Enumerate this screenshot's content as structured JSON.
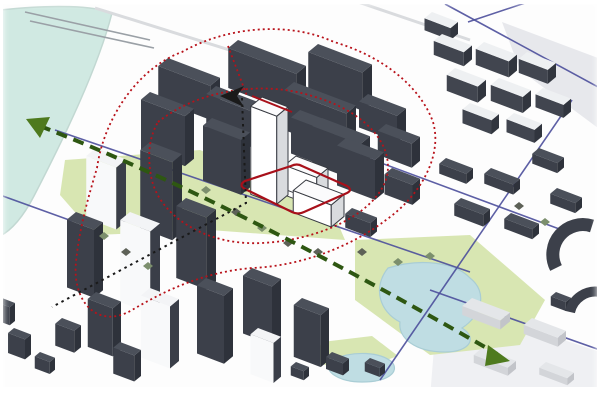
{
  "meta": {
    "title": "Urban design analysis diagram: axonometric city massing with landmark towers, view-axis arrows, influence loops, park and river",
    "canvas": {
      "w": 600,
      "h": 400
    }
  },
  "palette": {
    "ground": "#fdfdfd",
    "water": "#d0e9e2",
    "waterEdge": "#c2d8d2",
    "park": "#d6e5ae",
    "park2": "#dbe8ba",
    "pond": "#bfdde3",
    "pondEdge": "#a9cdd5",
    "road": "#4c4f9c",
    "faintStreet": "#d9dbde",
    "plate": "#e7e8ec",
    "plate2": "#eff0f3",
    "bridge": "#9aa0a6",
    "redLine": "#b8121a",
    "redSolid": "#a8101a",
    "black": "#1a1a1a",
    "greenAxis": "#2e5712",
    "greenArrow": "#4e7a1e",
    "tree1": "#7c8f6d",
    "tree2": "#5d6157",
    "styles": {
      "dark": {
        "top": "#4b505a",
        "left": "#3c404a",
        "right": "#2e323b"
      },
      "darkLightTop": {
        "top": "#eef0f2",
        "left": "#41454f",
        "right": "#31353e"
      },
      "lightSide": {
        "top": "#f3f4f6",
        "left": "#f8f9fa",
        "right": "#3a3e48"
      },
      "white": {
        "top": "#fbfbfc",
        "left": "#ffffff",
        "right": "#d9dbde",
        "stroke": "#383b42"
      },
      "lowGray": {
        "top": "#e4e6e9",
        "left": "#d3d5d9",
        "right": "#c2c4c9"
      }
    }
  },
  "scene": {
    "water": {
      "path": "M 0,10 C 55,4 95,6 112,13 C 98,68 64,138 34,196 C 22,219 10,231 0,236 Z"
    },
    "bridge": {
      "lines": [
        [
          25,
          12,
          150,
          40
        ],
        [
          30,
          21,
          154,
          48
        ]
      ]
    },
    "faintStreets": [
      [
        95,
        8,
        268,
        62
      ],
      [
        358,
        2,
        470,
        40
      ]
    ],
    "groundPlates": [
      {
        "points": "502,22 598,58 598,128 520,70",
        "fill": "plate"
      },
      {
        "points": "438,298 600,352 600,398 430,398",
        "fill": "plate2"
      }
    ],
    "parks": [
      {
        "path": "M 65,160 L 200,150 L 330,205 L 345,240 L 210,230 L 95,235 L 60,195 Z"
      },
      {
        "path": "M 355,240 L 470,235 L 545,300 L 520,345 L 430,355 L 355,300 Z"
      },
      {
        "path": "M 322,342 L 372,336 L 398,356 L 352,372 L 314,362 Z"
      }
    ],
    "pond": {
      "paths": [
        "M 388,268 C 420,258 455,262 470,278 C 488,292 482,315 462,328 C 478,338 470,352 445,352 C 415,352 398,338 400,322 C 380,312 372,288 388,268 Z",
        "M 330,360 C 355,350 380,352 392,362 C 400,372 388,382 362,382 C 340,382 322,372 330,360 Z"
      ]
    },
    "roads": [
      [
        445,
        4,
        600,
        88
      ],
      [
        468,
        22,
        528,
        2
      ],
      [
        572,
        100,
        380,
        380
      ],
      [
        168,
        84,
        562,
        230
      ],
      [
        55,
        130,
        470,
        272
      ],
      [
        430,
        290,
        600,
        350
      ],
      [
        0,
        195,
        72,
        221
      ]
    ],
    "buildings": [
      [
        168,
        58,
        52,
        13,
        34,
        "dark"
      ],
      [
        238,
        40,
        68,
        13,
        40,
        "dark"
      ],
      [
        318,
        44,
        54,
        13,
        38,
        "dark"
      ],
      [
        150,
        92,
        44,
        12,
        50,
        "dark"
      ],
      [
        216,
        86,
        58,
        13,
        36,
        "dark"
      ],
      [
        294,
        82,
        62,
        13,
        40,
        "dark"
      ],
      [
        368,
        94,
        38,
        12,
        26,
        "dark"
      ],
      [
        212,
        118,
        38,
        12,
        55,
        "dark"
      ],
      [
        322,
        118,
        48,
        13,
        38,
        "dark"
      ],
      [
        386,
        124,
        34,
        11,
        24,
        "dark"
      ],
      [
        300,
        110,
        34,
        12,
        36,
        "dark"
      ],
      [
        442,
        34,
        30,
        11,
        14,
        "darkLightTop"
      ],
      [
        484,
        42,
        33,
        11,
        16,
        "darkLightTop"
      ],
      [
        527,
        52,
        29,
        11,
        14,
        "darkLightTop"
      ],
      [
        455,
        68,
        31,
        11,
        16,
        "darkLightTop"
      ],
      [
        499,
        78,
        32,
        11,
        16,
        "darkLightTop"
      ],
      [
        543,
        88,
        28,
        10,
        13,
        "darkLightTop"
      ],
      [
        470,
        103,
        29,
        10,
        14,
        "darkLightTop"
      ],
      [
        514,
        113,
        28,
        10,
        13,
        "darkLightTop"
      ],
      [
        432,
        12,
        26,
        10,
        12,
        "darkLightTop"
      ],
      [
        446,
        158,
        27,
        9,
        10,
        "dark"
      ],
      [
        491,
        168,
        29,
        9,
        10,
        "dark"
      ],
      [
        539,
        148,
        25,
        9,
        10,
        "dark"
      ],
      [
        461,
        198,
        29,
        9,
        12,
        "dark"
      ],
      [
        511,
        213,
        28,
        9,
        10,
        "dark"
      ],
      [
        557,
        188,
        25,
        9,
        10,
        "dark"
      ],
      [
        96,
        148,
        30,
        13,
        62,
        "lightSide"
      ],
      [
        150,
        142,
        32,
        13,
        78,
        "dark"
      ],
      [
        76,
        212,
        27,
        12,
        68,
        "dark"
      ],
      [
        130,
        212,
        30,
        13,
        82,
        "lightSide"
      ],
      [
        186,
        198,
        30,
        13,
        72,
        "dark"
      ],
      [
        96,
        292,
        25,
        11,
        48,
        "dark"
      ],
      [
        150,
        288,
        29,
        12,
        62,
        "lightSide"
      ],
      [
        206,
        278,
        27,
        12,
        68,
        "dark"
      ],
      [
        252,
        268,
        29,
        12,
        58,
        "dark"
      ],
      [
        62,
        318,
        19,
        9,
        22,
        "dark"
      ],
      [
        120,
        342,
        21,
        9,
        26,
        "dark"
      ],
      [
        302,
        298,
        27,
        11,
        52,
        "dark"
      ],
      [
        258,
        328,
        23,
        10,
        40,
        "lightSide"
      ],
      [
        332,
        352,
        17,
        8,
        12,
        "dark"
      ],
      [
        370,
        358,
        15,
        7,
        9,
        "dark"
      ],
      [
        296,
        362,
        13,
        7,
        9,
        "dark"
      ],
      [
        346,
        138,
        38,
        12,
        40,
        "dark"
      ],
      [
        392,
        168,
        28,
        10,
        20,
        "dark"
      ],
      [
        352,
        208,
        25,
        9,
        14,
        "dark"
      ],
      [
        472,
        298,
        38,
        13,
        9,
        "lowGray"
      ],
      [
        532,
        318,
        34,
        11,
        9,
        "lowGray"
      ],
      [
        482,
        348,
        34,
        11,
        8,
        "lowGray"
      ],
      [
        546,
        362,
        28,
        9,
        7,
        "lowGray"
      ],
      [
        556,
        292,
        15,
        7,
        9,
        "dark"
      ],
      [
        14,
        328,
        17,
        8,
        20,
        "dark"
      ],
      [
        40,
        352,
        15,
        7,
        12,
        "dark"
      ],
      [
        2,
        298,
        13,
        7,
        18,
        "dark"
      ],
      [
        262,
        97,
        26,
        15,
        88,
        "white"
      ],
      [
        296,
        156,
        32,
        15,
        24,
        "white"
      ],
      [
        306,
        180,
        38,
        17,
        22,
        "white"
      ],
      [
        287,
        170,
        17,
        11,
        16,
        "white"
      ]
    ],
    "arcBuildings": [
      {
        "d": "M 556,268 A 30,30 0 0 1 592,226",
        "w": 13
      },
      {
        "d": "M 570,312 A 26,26 0 0 1 600,292",
        "w": 10
      }
    ],
    "trees": [
      [
        104,
        236
      ],
      [
        126,
        252
      ],
      [
        148,
        266
      ],
      [
        236,
        212
      ],
      [
        262,
        228
      ],
      [
        288,
        243
      ],
      [
        206,
        190
      ],
      [
        318,
        252
      ],
      [
        430,
        256
      ],
      [
        519,
        206
      ],
      [
        545,
        222
      ],
      [
        362,
        252
      ],
      [
        398,
        262
      ]
    ],
    "overlays": {
      "redLoops": [
        "M 97,168 C 104,118 138,68 182,52 C 224,28 286,20 334,42 C 382,56 420,86 433,122 C 443,156 420,196 386,220 C 352,246 302,266 252,268 C 204,272 166,290 132,310 C 98,330 72,302 76,262 C 79,230 88,198 97,168 Z",
        "M 158,122 C 198,90 262,80 312,96 C 362,110 394,142 387,176 C 378,212 322,240 262,243 C 206,246 158,216 151,176 C 147,152 150,136 158,122 Z"
      ],
      "redSegments": [
        "M 228,46 L 247,96"
      ],
      "redSolidSegments": [
        "M 252,96 L 292,112"
      ],
      "redParcel": "M 245,181 Q 238,185 245,189 L 292,212 Q 298,215 304,212 L 347,193 Q 353,190 347,186 L 302,166 Q 297,163 291,166 Z",
      "blackAxis": {
        "points": "242,98 246,203 52,307",
        "arrow": "220,96 244,86 237,96 244,107"
      },
      "greenAxis": {
        "path": "M 40,126 Q 230,200 497,354",
        "arrowStart": "26,119 50,117 40,138",
        "arrowEnd": "510,361 488,345 485,366"
      }
    }
  }
}
